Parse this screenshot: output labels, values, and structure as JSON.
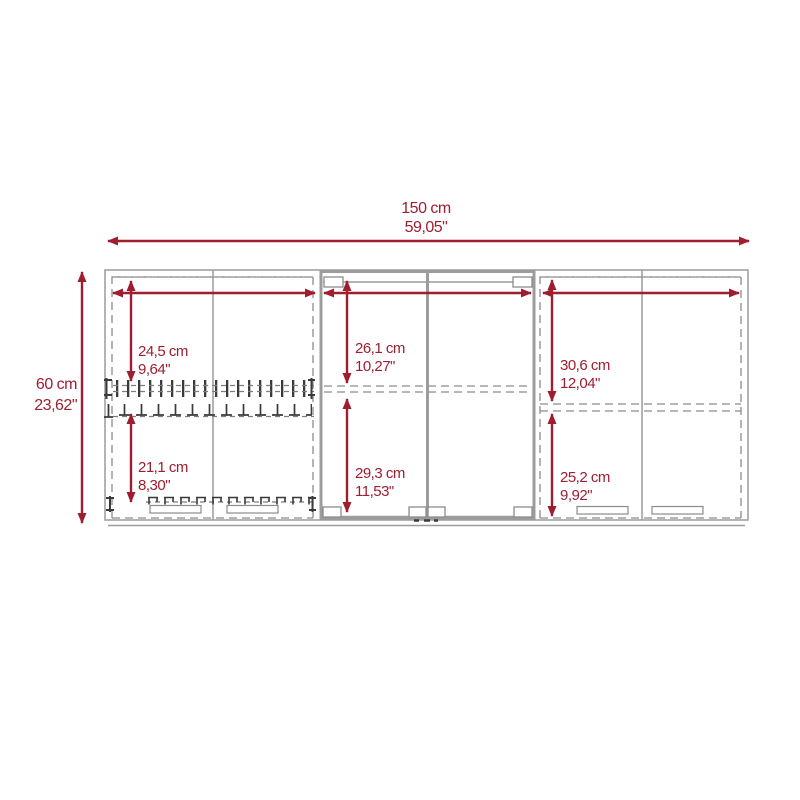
{
  "title": "Wall cabinet dimension diagram",
  "colors": {
    "dimension_accent": "#9E1E30",
    "cabinet_line": "#9C9C9C",
    "cabinet_dash": "#8C8C8C",
    "detail_dark": "#3A3A3A",
    "background": "#FFFFFF"
  },
  "overall": {
    "width_cm": "150 cm",
    "width_in": "59,05\"",
    "height_cm": "60 cm",
    "height_in": "23,62\""
  },
  "left_section": {
    "upper_cm": "24,5 cm",
    "upper_in": "9,64\"",
    "lower_cm": "21,1 cm",
    "lower_in": "8,30\""
  },
  "center_section": {
    "upper_cm": "26,1 cm",
    "upper_in": "10,27\"",
    "lower_cm": "29,3 cm",
    "lower_in": "11,53\""
  },
  "right_section": {
    "upper_cm": "30,6 cm",
    "upper_in": "12,04\"",
    "lower_cm": "25,2 cm",
    "lower_in": "9,92\""
  }
}
